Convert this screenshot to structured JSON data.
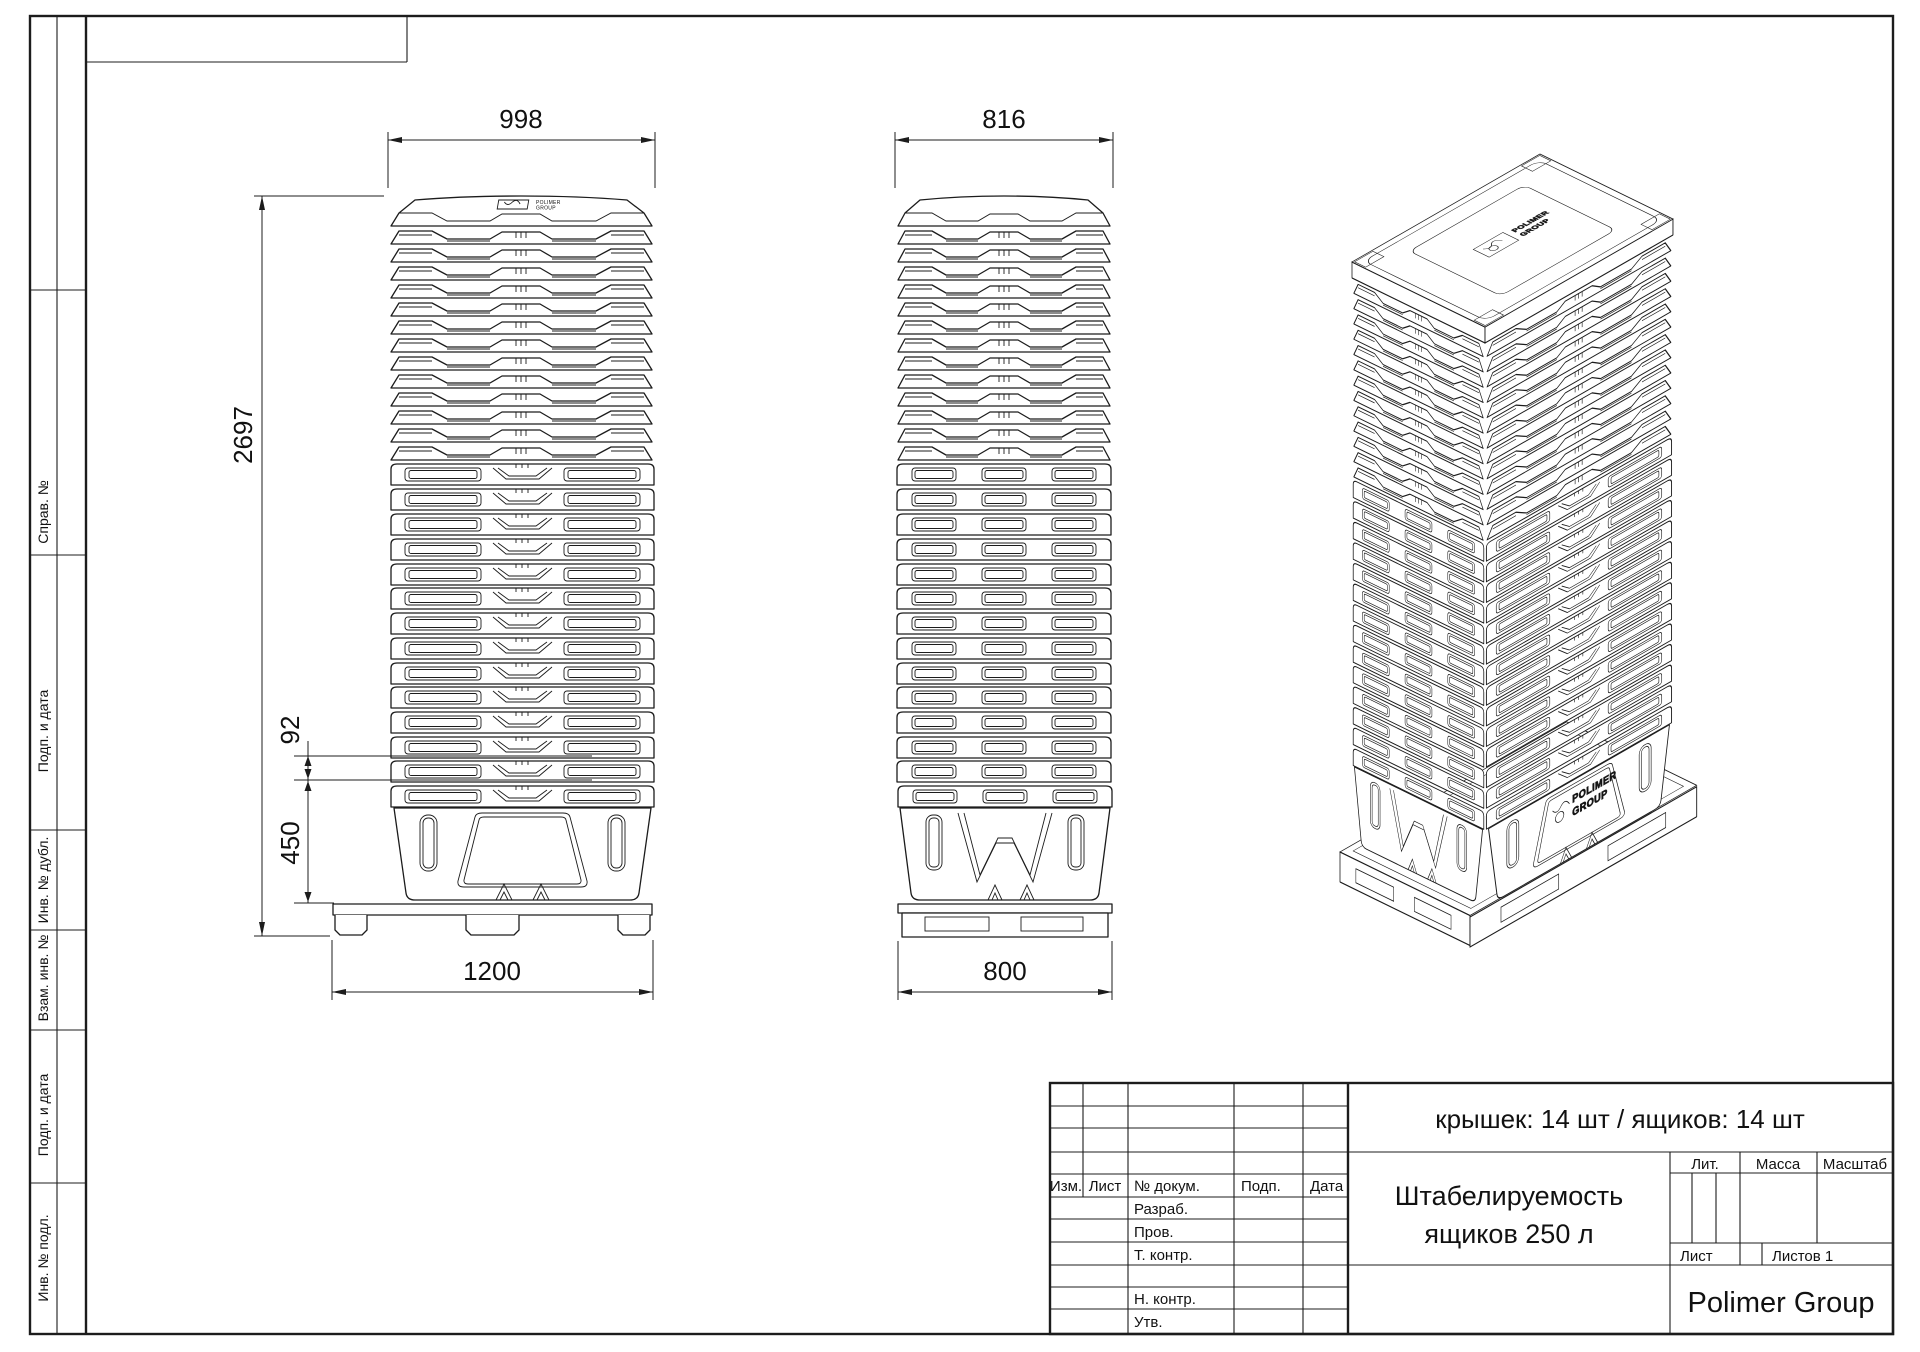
{
  "drawing": {
    "summary": "крышек: 14 шт   /   ящиков: 14 шт",
    "doc_name_line1": "Штабелируемость",
    "doc_name_line2": "ящиков 250 л",
    "company": "Polimer Group"
  },
  "margin": {
    "labels": [
      "Справ. №",
      "Подп. и дата",
      "Инв. № дубл.",
      "Взам. инв. №",
      "Подп. и дата",
      "Инв. № подл."
    ]
  },
  "title_block": {
    "col_izm": "Изм.",
    "col_list": "Лист",
    "col_dokum": "№ докум.",
    "col_podp": "Подп.",
    "col_data": "Дата",
    "row_razrab": "Разраб.",
    "row_prov": "Пров.",
    "row_tkontr": "Т. контр.",
    "row_nkontr": "Н. контр.",
    "row_utv": "Утв.",
    "lit": "Лит.",
    "massa": "Масса",
    "masshtab": "Масштаб",
    "list": "Лист",
    "listov": "Листов 1"
  },
  "dimensions": {
    "front_width": "998",
    "front_height": "2697",
    "front_pitch": "92",
    "front_box": "450",
    "front_pallet": "1200",
    "side_width": "816",
    "side_pallet": "800"
  },
  "logo": {
    "line1": "POLIMER",
    "line2": "GROUP"
  }
}
